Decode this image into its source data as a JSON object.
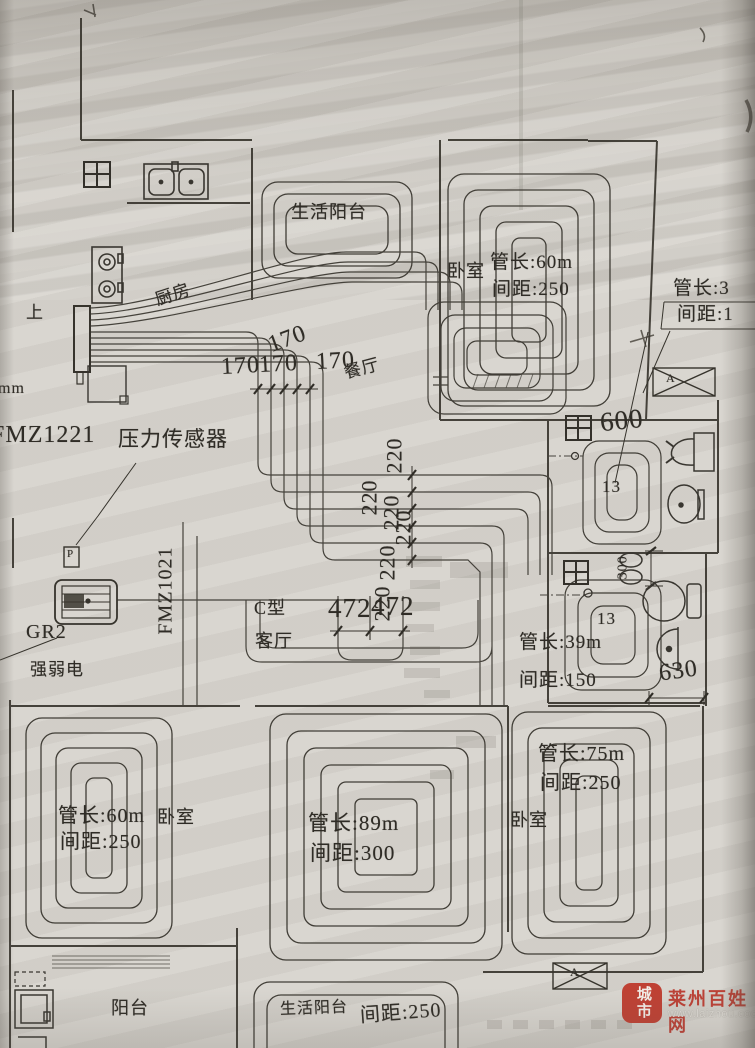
{
  "rooms": {
    "balcony_top": {
      "label": "生活阳台"
    },
    "kitchen": {
      "label": "厨房"
    },
    "dining": {
      "label": "餐厅"
    },
    "bedroom_top_right": {
      "label": "卧室",
      "pipe_length": "管长:60m",
      "spacing": "间距:250"
    },
    "edge_room_right": {
      "pipe_length": "管长:3",
      "spacing": "间距:1"
    },
    "living": {
      "shape_label": "C型",
      "label": "客厅"
    },
    "bath_upper": {
      "coil_label": "13"
    },
    "bath_lower": {
      "coil_label": "13",
      "pipe_length": "管长:39m",
      "spacing": "间距:150"
    },
    "bedroom_bottom_left": {
      "label": "卧室",
      "pipe_length": "管长:60m",
      "spacing": "间距:250"
    },
    "living_bottom": {
      "pipe_length": "管长:89m",
      "spacing": "间距:300"
    },
    "bedroom_bottom_right": {
      "label": "卧室",
      "pipe_length": "管长:75m",
      "spacing": "间距:250"
    },
    "balcony_bottom_left": {
      "label": "阳台"
    },
    "balcony_bottom_right": {
      "label": "生活阳台",
      "spacing": "间距:250"
    }
  },
  "equipment": {
    "manifold_model": "FMZ1221",
    "manifold_model_2": "FMZ1021",
    "pressure_sensor": "压力传感器",
    "pressure_symbol": "P",
    "heat_source": "GR2",
    "electrical": "强弱电",
    "direction_up": "上",
    "unit_partial": "mm"
  },
  "dimensions": {
    "d170_rotated": "170",
    "d170": [
      "170",
      "170",
      "170"
    ],
    "d220": [
      "220",
      "220",
      "220",
      "220",
      "220",
      "220"
    ],
    "d472": [
      "472",
      "472"
    ],
    "d600": "600",
    "d300": "300",
    "d630": "630"
  },
  "markers": {
    "section_a_top": "A",
    "section_a_bottom": "A"
  },
  "watermark": {
    "seal": "城市",
    "site_name": "莱州百姓网",
    "site_url": "www.laizhou.cooo.cn",
    "accent_red": "#bf4134"
  }
}
